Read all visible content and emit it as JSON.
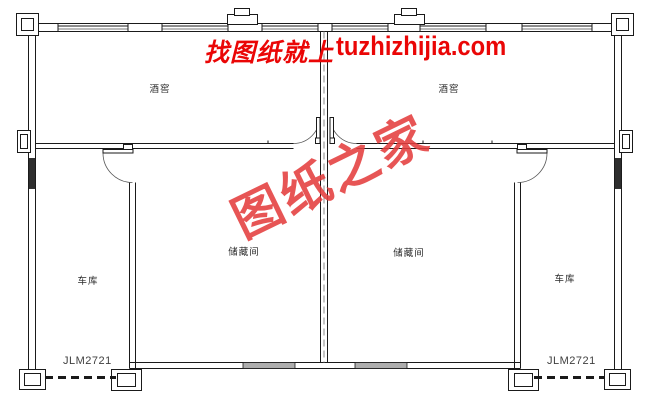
{
  "header": {
    "prefix": "找图纸就上",
    "domain": "tuzhizhijia.com"
  },
  "watermark": {
    "text": "图纸之家"
  },
  "rooms": {
    "wine_cellar_left": {
      "label": "酒窖"
    },
    "wine_cellar_right": {
      "label": "酒窖"
    },
    "storage_left": {
      "label": "储藏间"
    },
    "storage_right": {
      "label": "储藏间"
    },
    "garage_left": {
      "label": "车库"
    },
    "garage_right": {
      "label": "车库"
    }
  },
  "garage_doors": {
    "left_model": "JLM2721",
    "right_model": "JLM2721"
  },
  "colors": {
    "line": "#1a1a1a",
    "title_red": "#ea0606",
    "watermark_red": "#e43e3e",
    "window_fill": "#adadad",
    "dark_window_fill": "#2e2e2e"
  }
}
